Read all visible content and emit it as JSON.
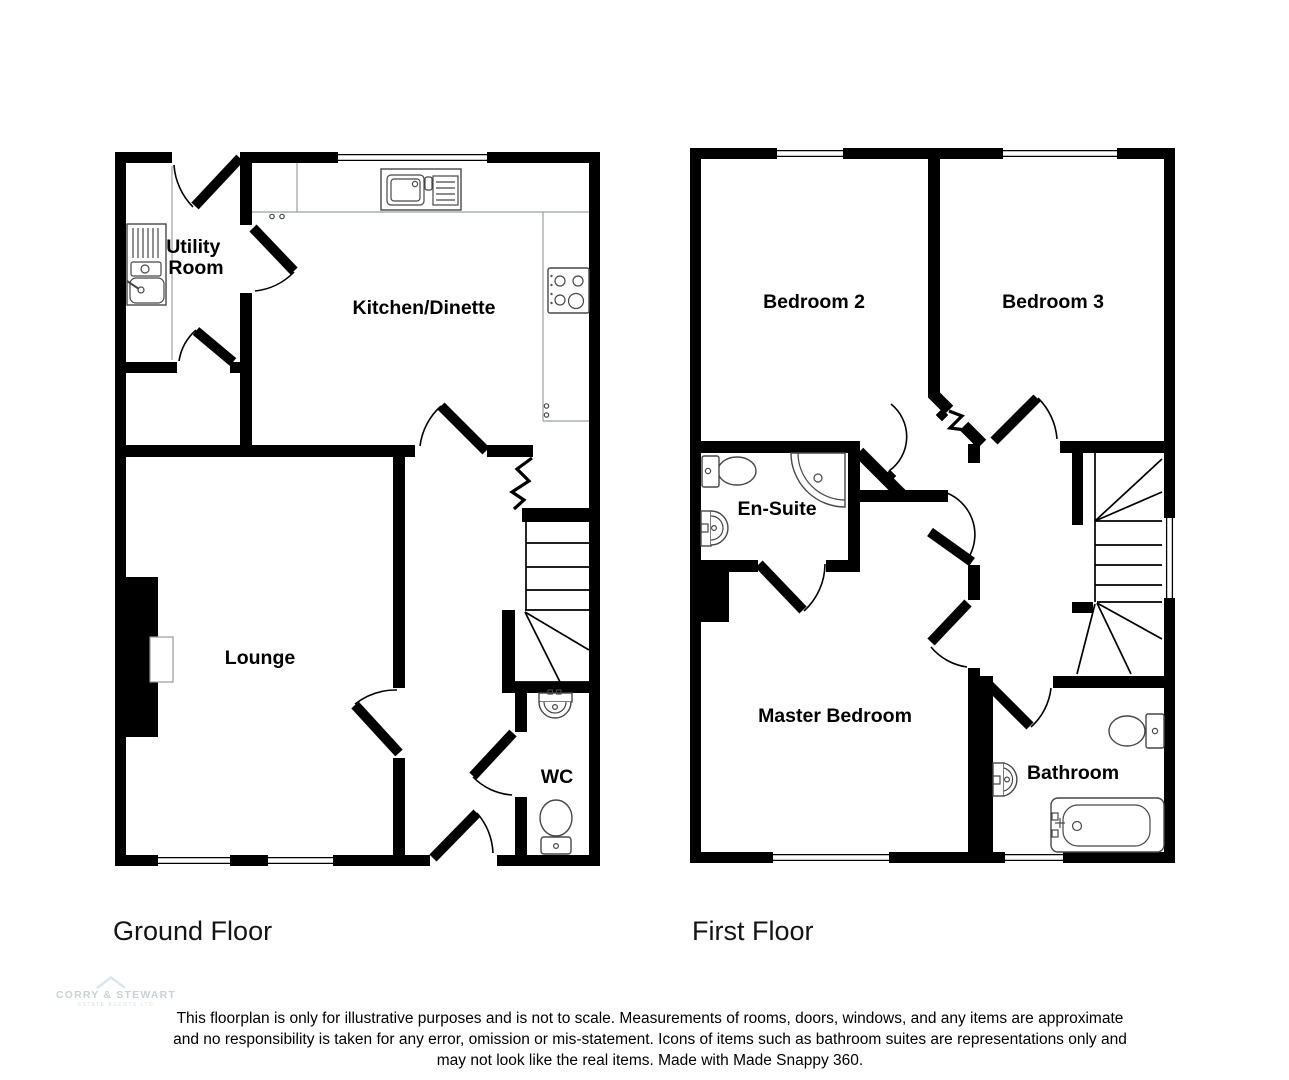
{
  "colors": {
    "wall": "#000000",
    "fixture_stroke": "#474747",
    "counter_stroke": "#9aa1a6",
    "logo_text": "#c9d0d6",
    "logo_chevron": "#dae5ed"
  },
  "ground_floor": {
    "caption": "Ground Floor",
    "rooms": {
      "utility_line1": "Utility",
      "utility_line2": "Room",
      "kitchen": "Kitchen/Dinette",
      "lounge": "Lounge",
      "wc": "WC"
    }
  },
  "first_floor": {
    "caption": "First Floor",
    "rooms": {
      "bedroom2": "Bedroom 2",
      "bedroom3": "Bedroom 3",
      "ensuite": "En-Suite",
      "master": "Master Bedroom",
      "bathroom": "Bathroom"
    }
  },
  "footer": {
    "disclaimer_line1": "This floorplan is only for illustrative purposes and is not to scale. Measurements of rooms, doors, windows, and any items are approximate",
    "disclaimer_line2": "and no responsibility is taken for any error, omission or mis-statement. Icons of items such as bathroom suites are representations only and",
    "disclaimer_line3": "may not look like the real items. Made with Made Snappy 360.",
    "logo": {
      "name": "CORRY & STEWART",
      "subtext": "ESTATE AGENTS LTD"
    }
  }
}
